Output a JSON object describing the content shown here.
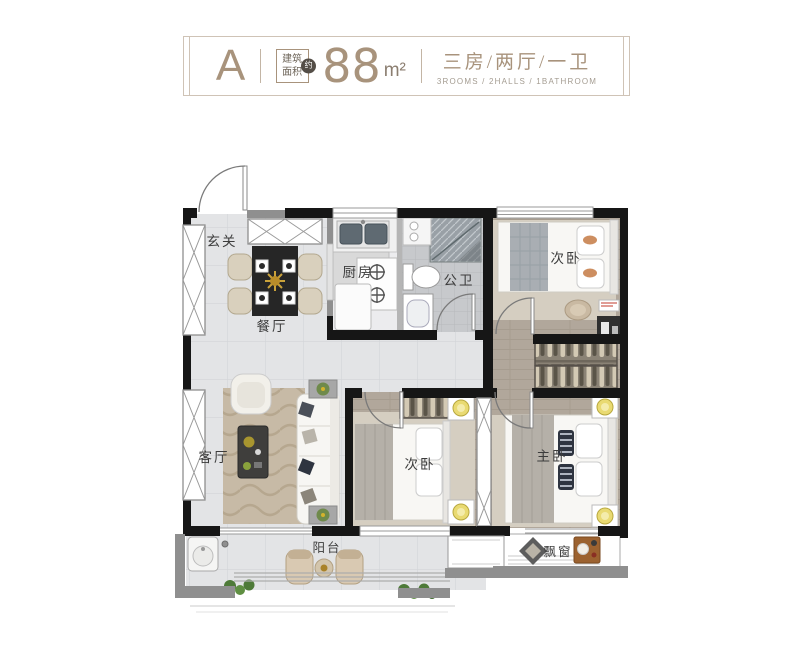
{
  "header": {
    "unit_letter": "A",
    "area_box_line1": "建筑",
    "area_box_line2": "面积",
    "area_badge": "约",
    "area_value": "88",
    "area_unit": "m²",
    "layout_cn": "三房/两厅/一卫",
    "layout_en": "3ROOMS / 2HALLS / 1BATHROOM",
    "accent_color": "#a8937c"
  },
  "rooms": {
    "entry": {
      "label": "玄关"
    },
    "dining": {
      "label": "餐厅"
    },
    "kitchen": {
      "label": "厨房"
    },
    "bathroom": {
      "label": "公卫"
    },
    "bedroom_top": {
      "label": "次卧"
    },
    "living": {
      "label": "客厅"
    },
    "bedroom_mid": {
      "label": "次卧"
    },
    "master": {
      "label": "主卧"
    },
    "balcony": {
      "label": "阳台"
    },
    "bay_window": {
      "label": "飘窗"
    }
  }
}
